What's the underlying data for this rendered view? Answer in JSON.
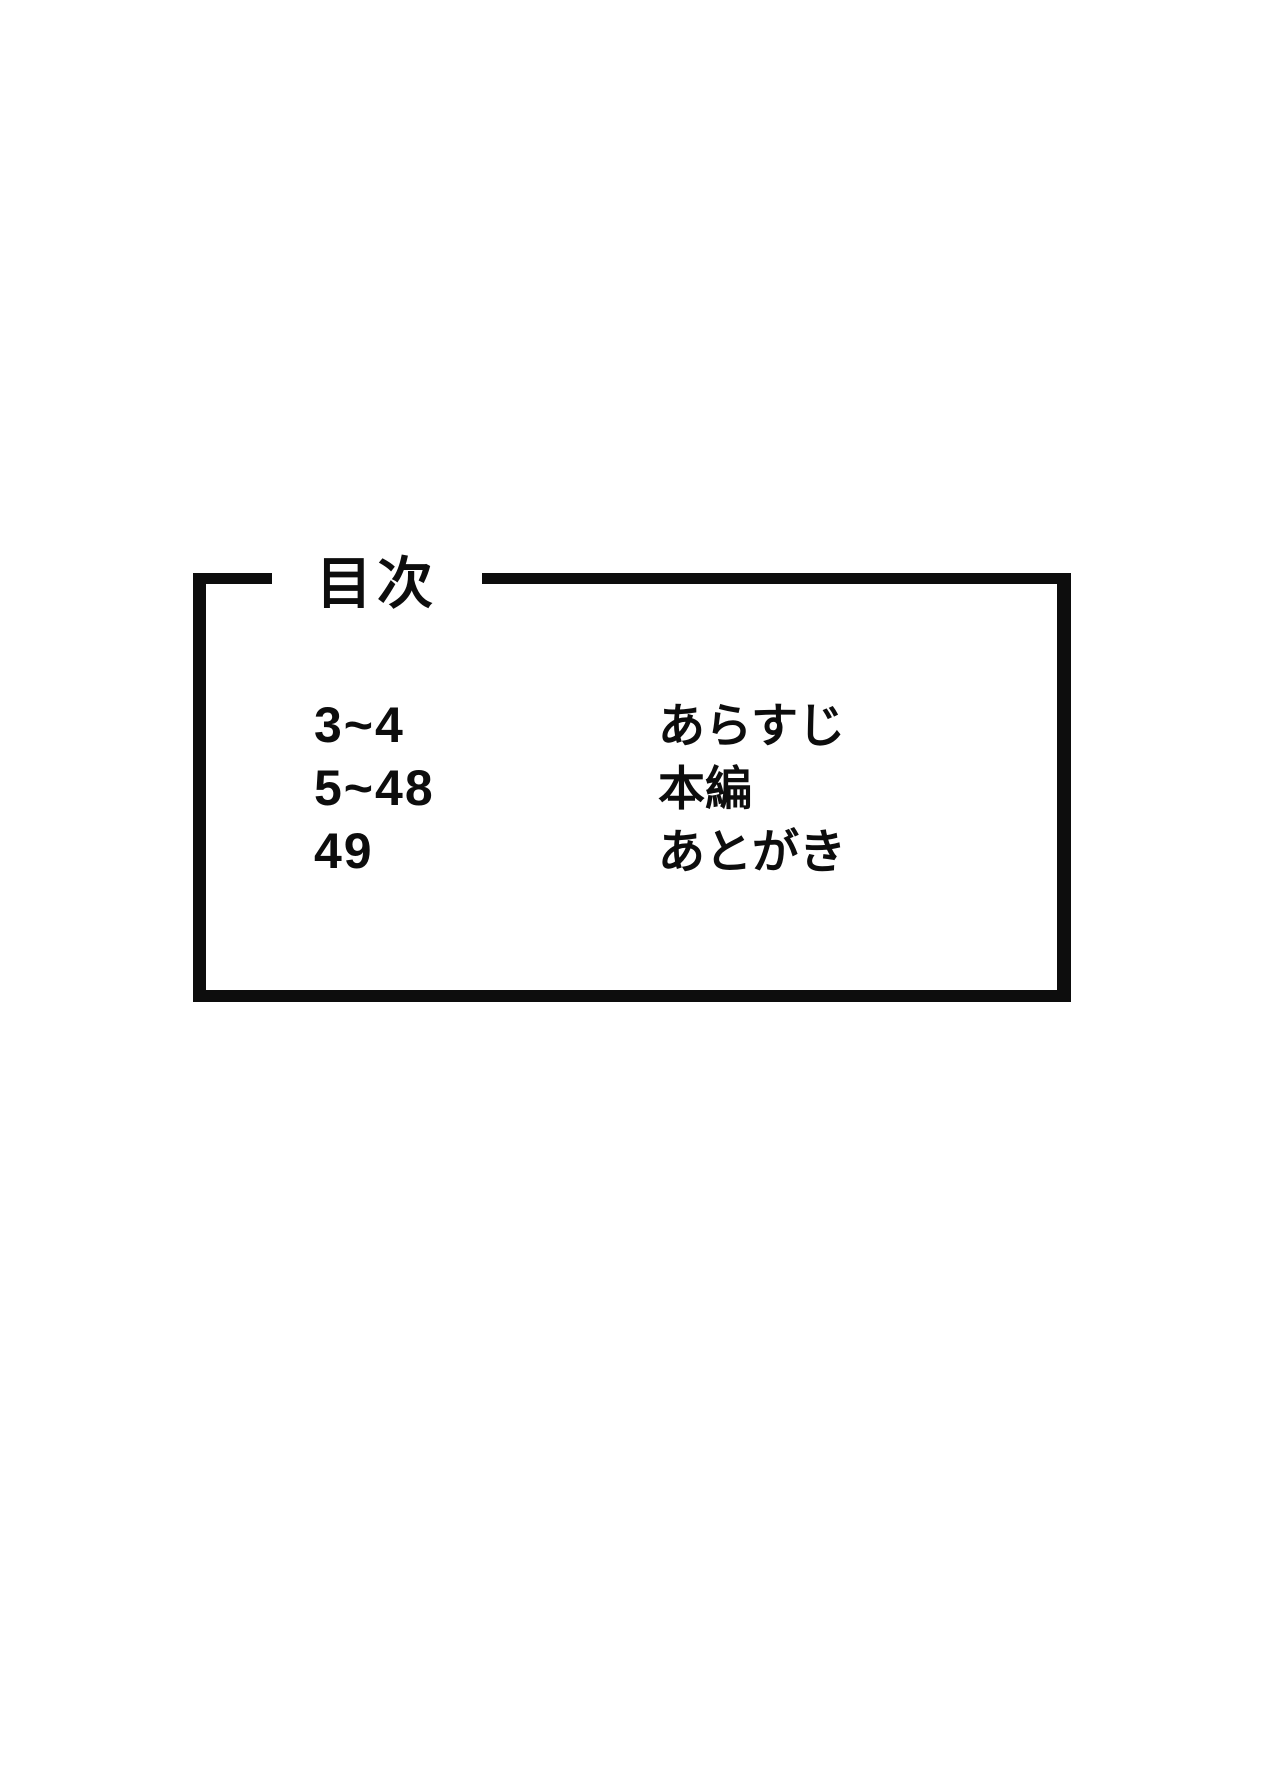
{
  "page": {
    "background": "#ffffff",
    "ink": "#0d0d0d"
  },
  "toc": {
    "title": "目次",
    "rows": [
      {
        "pages": "3~4",
        "label": "あらすじ"
      },
      {
        "pages": "5~48",
        "label": "本編"
      },
      {
        "pages": "49",
        "label": "あとがき"
      }
    ]
  }
}
